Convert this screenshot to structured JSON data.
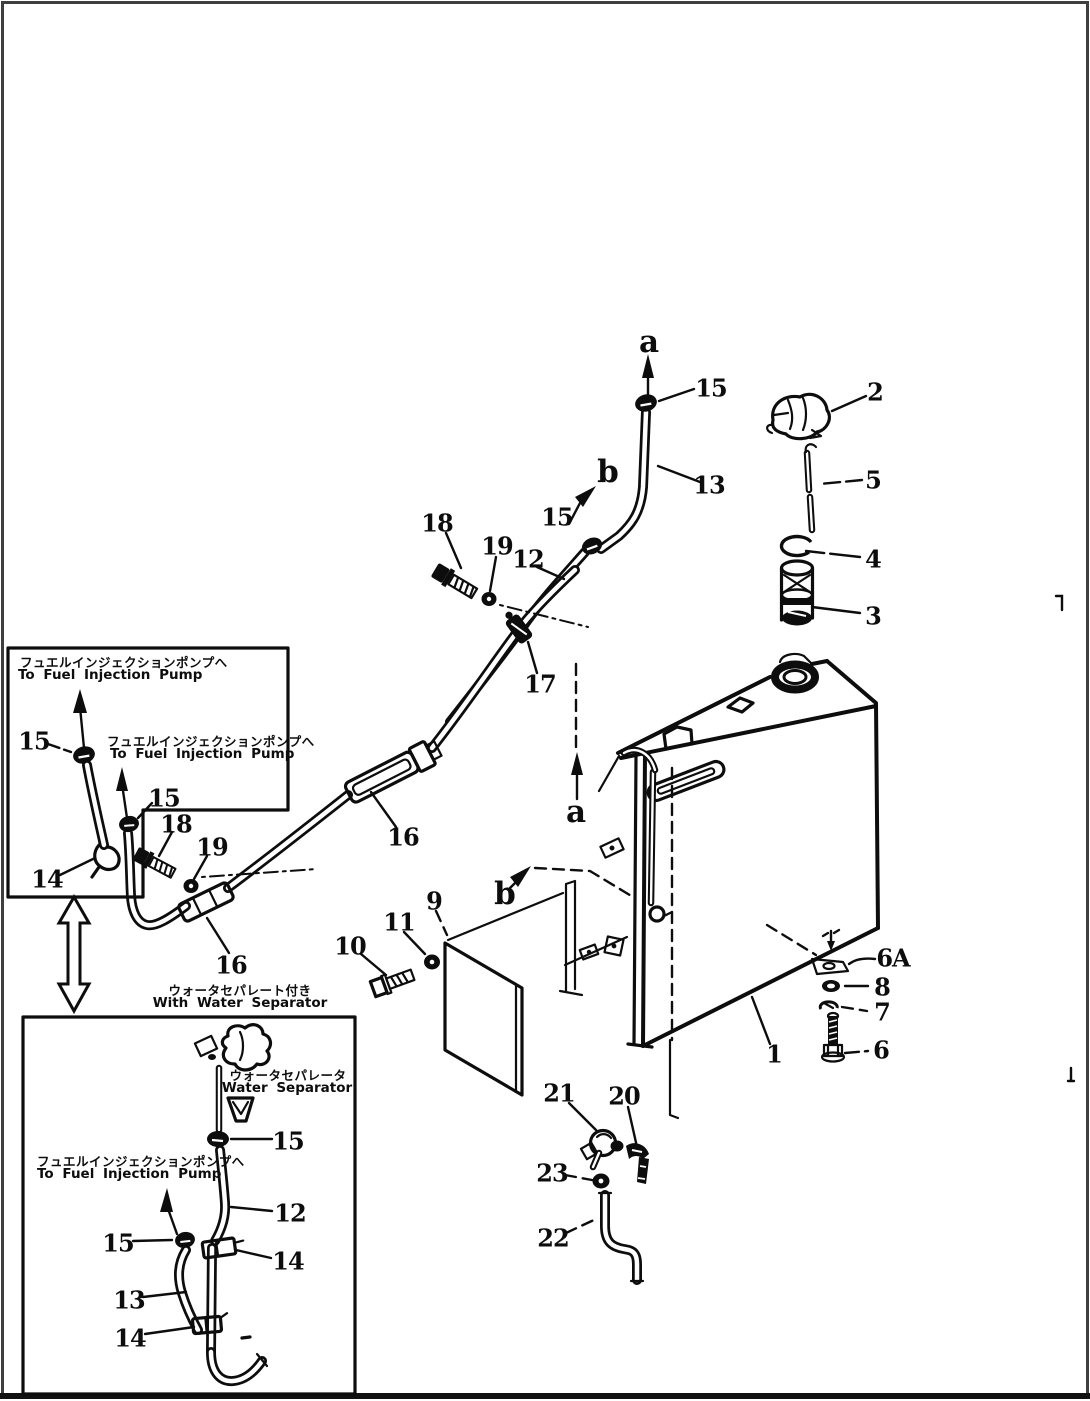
{
  "page": {
    "background": "#ffffff",
    "ink_color": "#0d0d0d",
    "frame_color": "#3f3f3f"
  },
  "figure": {
    "type": "exploded-parts-diagram",
    "subject": "fuel tank and fuel piping",
    "text_blocks": {
      "to_pump_jp": "フュエルインジェクションポンプへ",
      "to_pump_en": "To Fuel Injection Pump",
      "with_separator_jp": "ウォータセパレート付き",
      "with_separator_en": "With Water Separator",
      "separator_jp": "ウォータセパレータ",
      "separator_en": "Water Separator"
    },
    "part_labels": [
      {
        "text": "a",
        "x": 649,
        "y": 342,
        "kind": "view"
      },
      {
        "text": "15",
        "x": 711,
        "y": 388,
        "kind": "num"
      },
      {
        "text": "2",
        "x": 875,
        "y": 392,
        "kind": "num"
      },
      {
        "text": "b",
        "x": 608,
        "y": 472,
        "kind": "view"
      },
      {
        "text": "13",
        "x": 709,
        "y": 485,
        "kind": "num"
      },
      {
        "text": "5",
        "x": 873,
        "y": 480,
        "kind": "num"
      },
      {
        "text": "15",
        "x": 557,
        "y": 517,
        "kind": "num"
      },
      {
        "text": "18",
        "x": 437,
        "y": 523,
        "kind": "num"
      },
      {
        "text": "19",
        "x": 497,
        "y": 546,
        "kind": "num"
      },
      {
        "text": "12",
        "x": 528,
        "y": 559,
        "kind": "num"
      },
      {
        "text": "4",
        "x": 873,
        "y": 559,
        "kind": "num"
      },
      {
        "text": "3",
        "x": 873,
        "y": 616,
        "kind": "num"
      },
      {
        "text": "17",
        "x": 540,
        "y": 684,
        "kind": "num"
      },
      {
        "text": "15",
        "x": 34,
        "y": 741,
        "kind": "num"
      },
      {
        "text": "15",
        "x": 164,
        "y": 798,
        "kind": "num"
      },
      {
        "text": "18",
        "x": 176,
        "y": 824,
        "kind": "num"
      },
      {
        "text": "19",
        "x": 212,
        "y": 847,
        "kind": "num"
      },
      {
        "text": "14",
        "x": 47,
        "y": 879,
        "kind": "num"
      },
      {
        "text": "16",
        "x": 403,
        "y": 837,
        "kind": "num"
      },
      {
        "text": "16",
        "x": 231,
        "y": 965,
        "kind": "num"
      },
      {
        "text": "a",
        "x": 576,
        "y": 812,
        "kind": "view"
      },
      {
        "text": "b",
        "x": 505,
        "y": 894,
        "kind": "view"
      },
      {
        "text": "9",
        "x": 434,
        "y": 901,
        "kind": "num"
      },
      {
        "text": "11",
        "x": 399,
        "y": 922,
        "kind": "num"
      },
      {
        "text": "10",
        "x": 350,
        "y": 946,
        "kind": "num"
      },
      {
        "text": "6A",
        "x": 893,
        "y": 958,
        "kind": "num"
      },
      {
        "text": "8",
        "x": 882,
        "y": 987,
        "kind": "num"
      },
      {
        "text": "7",
        "x": 882,
        "y": 1012,
        "kind": "num"
      },
      {
        "text": "6",
        "x": 881,
        "y": 1050,
        "kind": "num"
      },
      {
        "text": "1",
        "x": 774,
        "y": 1054,
        "kind": "num"
      },
      {
        "text": "21",
        "x": 559,
        "y": 1093,
        "kind": "num"
      },
      {
        "text": "20",
        "x": 624,
        "y": 1096,
        "kind": "num"
      },
      {
        "text": "23",
        "x": 552,
        "y": 1173,
        "kind": "num"
      },
      {
        "text": "22",
        "x": 553,
        "y": 1238,
        "kind": "num"
      },
      {
        "text": "15",
        "x": 288,
        "y": 1141,
        "kind": "num"
      },
      {
        "text": "12",
        "x": 290,
        "y": 1213,
        "kind": "num"
      },
      {
        "text": "15",
        "x": 118,
        "y": 1243,
        "kind": "num"
      },
      {
        "text": "14",
        "x": 288,
        "y": 1261,
        "kind": "num"
      },
      {
        "text": "13",
        "x": 129,
        "y": 1300,
        "kind": "num"
      },
      {
        "text": "14",
        "x": 130,
        "y": 1338,
        "kind": "num"
      }
    ]
  }
}
